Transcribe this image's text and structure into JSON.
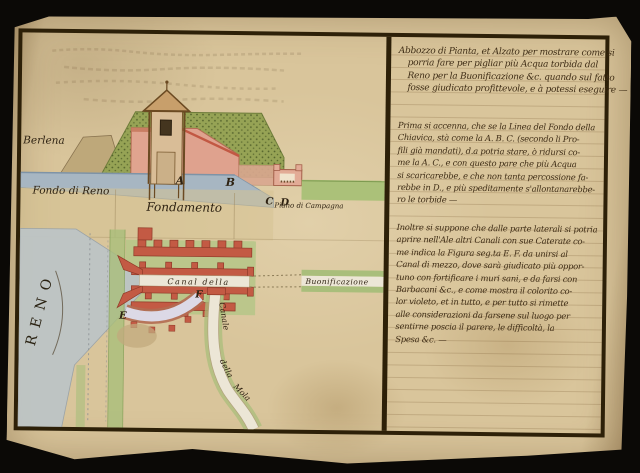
{
  "document_type": "manuscript plan and elevation with handwritten notes",
  "colors": {
    "background": "#0b0906",
    "parchment": "#d9c59b",
    "frame_ink": "#2d2008",
    "writing_ink": "#3f2d16",
    "water_blue": "#a7b6c2",
    "river_grey": "#bdc4c6",
    "rampart_green": "#96a355",
    "field_green": "#abc179",
    "wall_pink": "#e0a48f",
    "fort_red": "#c35a44",
    "canal_violet": "#dcd9e6"
  },
  "labels": {
    "elevation": {
      "berlena": "Berlena",
      "fondo_di_reno": "Fondo di Reno",
      "fondamento": "Fondamento",
      "piano_di_campagna": "Piano di Campagna",
      "a": "A",
      "b": "B",
      "c": "C",
      "d": "D"
    },
    "plan": {
      "reno": "RENO",
      "canal_della": "Canal della",
      "buonificazione": "Buonificazione",
      "canale": "Canale",
      "della": "della",
      "mola": "Mola",
      "e": "E",
      "f": "F"
    }
  },
  "text": {
    "paragraphs": [
      {
        "lines": [
          "Abbozzo di Pianta, et Alzato per mostrare come si",
          "porria fare per pigliar più Acqua torbida dal",
          "Reno per la Buonificazione &c. quando sul fatto",
          "fosse giudicato profittevole, e à potessi eseguire —"
        ]
      },
      {
        "lines": [
          "Prima si accenna, che se la Linea del Fondo della",
          "Chiavica, stà come la A. B. C. (secondo li Pro-",
          "fili già mandati), d.a potria stare, ò ridursi co-",
          "me la A. C., e con questo pare che più Acqua",
          "si scaricarebbe, e che non tanta percossione fa-",
          "rebbe in D., e più speditamente s'allontanarebbe-",
          "ro le torbide —"
        ]
      },
      {
        "lines": [
          "Inoltre si suppone che dalle parte laterali si potria",
          "aprire nell'Ale altri Canali con sue Caterate co-",
          "me indica la Figura seg.ta E. F. da unirsi al",
          "Canal di mezzo, dove sarà giudicato più oppor-",
          "tuno con fortificare i muri sani, e da farsi con",
          "Barbacani &c., e come mostra il colorito co-",
          "lor violeto, et in tutto, e per tutto si rimette",
          "alle considerazioni da farsene sul luogo per",
          "sentirne poscia il parere, le difficoltà, la",
          "Spesa &c. —"
        ]
      }
    ]
  }
}
